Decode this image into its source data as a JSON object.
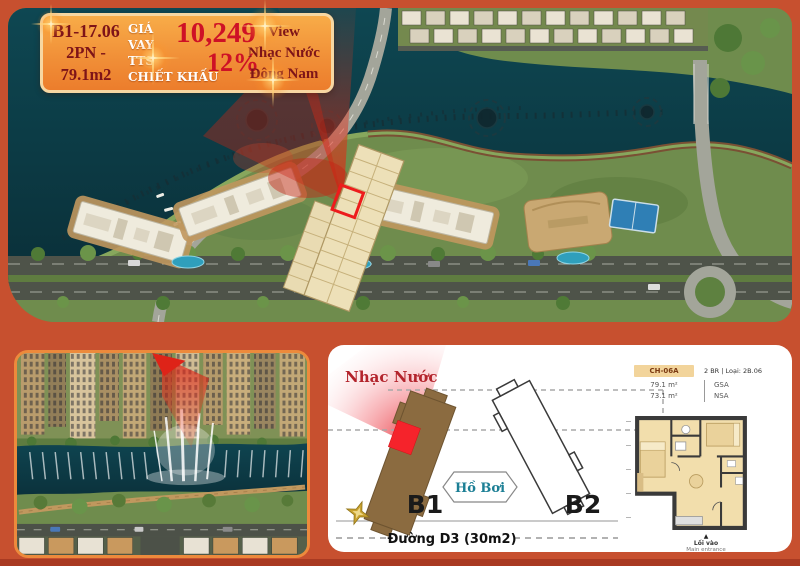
{
  "colors": {
    "page_bg": "#C7502F",
    "bottom_strip": "#A93A22",
    "callout_maroon": "#7E1418",
    "callout_red": "#CE1126",
    "plan_brown": "#8B6B40",
    "highlight_red": "#F5232B",
    "pool_teal": "#1C7F95"
  },
  "callout": {
    "unit_code": "B1-17.06",
    "bedrooms": "2PN -",
    "area": "79.1m2",
    "loan_l1": "GIÁ",
    "loan_l2": "VAY",
    "loan_l3": "TTS",
    "loan_l4": "CHIẾT KHẤU",
    "price": "10,249",
    "discount": "12%",
    "view_l1": "View",
    "view_l2": "Nhạc Nước",
    "view_l3": "Đông Nam"
  },
  "site_plan": {
    "fountain_label": "Nhạc Nước",
    "pool_label": "Hồ Bơi",
    "building1": "B1",
    "building2": "B2",
    "road_label": "Đường D3 (30m2)"
  },
  "floor_plan": {
    "type_code": "CH-06A",
    "type_info": "2 BR | Loại: 2B.06",
    "gsa_value": "79.1 m²",
    "gsa_label": "GSA",
    "nsa_value": "73.1 m²",
    "nsa_label": "NSA",
    "entrance_arrow": "▲",
    "entrance_vi": "Lối vào",
    "entrance_en": "Main entrance"
  }
}
